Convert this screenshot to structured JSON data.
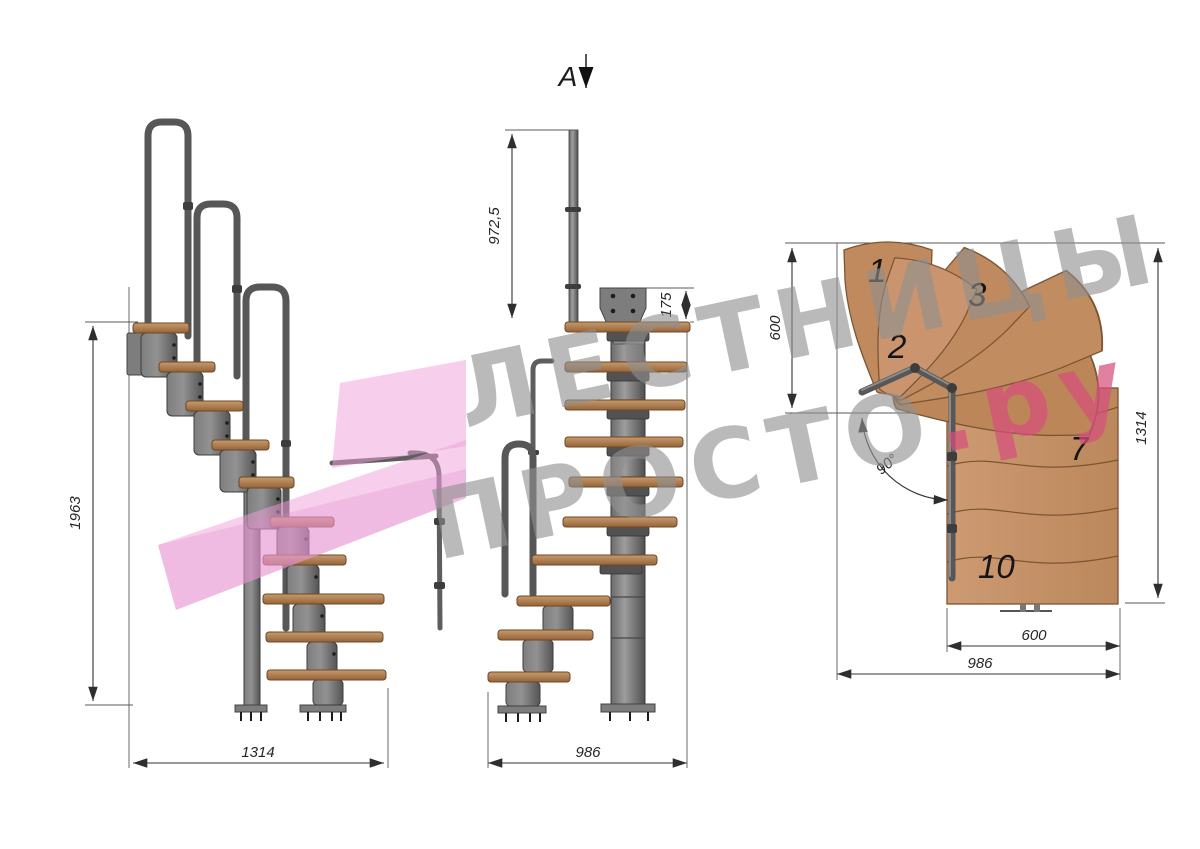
{
  "watermark": {
    "line1": "ЛЕСТНИЦЫ",
    "line2": "ПРОСТО",
    "line2_suffix": ".ру",
    "gray_color": "#8f8f8f",
    "pink_text_color": "#d64f7d",
    "arrow_color": "#ef9ed7"
  },
  "section_marker": {
    "label": "A"
  },
  "side_view": {
    "total_height_mm": "1963",
    "total_length_mm": "1314"
  },
  "front_view": {
    "handrail_height_mm": "972,5",
    "top_bracket_mm": "175",
    "total_depth_mm": "986"
  },
  "plan_view": {
    "entry_width_mm": "600",
    "right_length_mm": "1314",
    "run_width_mm": "600",
    "total_width_mm": "986",
    "turn_angle": "90°",
    "tread_numbers": [
      "1",
      "2",
      "3",
      "7",
      "10"
    ]
  },
  "colors": {
    "wood": "#c4906a",
    "metal": "#6e6e6e",
    "dimension": "#262626"
  }
}
